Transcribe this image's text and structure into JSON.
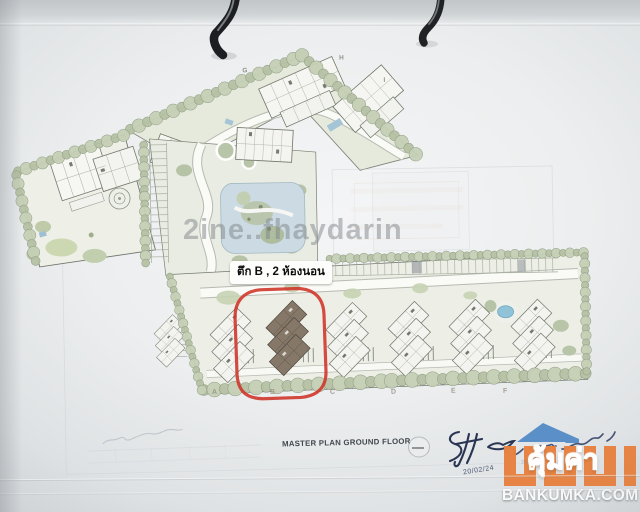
{
  "annotation": {
    "building_label": "ตึก B , 2 ห้องนอน",
    "highlight_color": "#cf372b"
  },
  "watermark": {
    "text": "2ine..fhaydarin"
  },
  "titleblock": {
    "title": "MASTER PLAN GROUND FLOOR",
    "handwritten_date": "20/02/24"
  },
  "plan": {
    "bottom_letters": [
      "A",
      "B",
      "C",
      "D",
      "E",
      "F"
    ],
    "top_letters": [
      "G",
      "H",
      "I"
    ]
  },
  "branding": {
    "logo_text": "คุ้มค่า",
    "website": "BANKUMKA.COM",
    "logo_orange": "#e8813f",
    "logo_blue": "#5a8fc7"
  },
  "colors": {
    "landscape_green": "#b5c0a4",
    "pool_blue": "#ccdae3",
    "paper": "#eceeef"
  }
}
